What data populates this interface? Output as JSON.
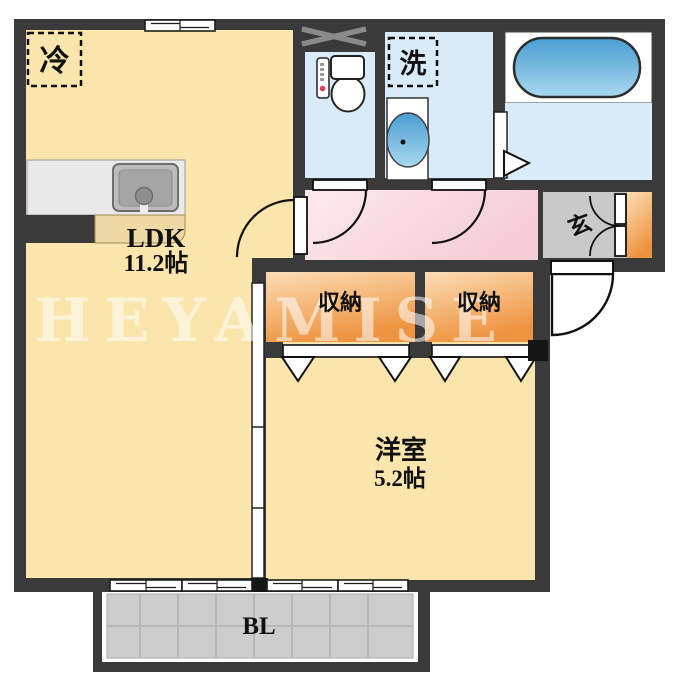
{
  "labels": {
    "ldk": "LDK",
    "ldk_size": "11.2帖",
    "western": "洋室",
    "western_size": "5.2帖",
    "storage1": "収納",
    "storage2": "収納",
    "entrance": "玄",
    "balcony": "BL",
    "fridge": "冷",
    "laundry": "洗",
    "watermark": "HEYAMISE"
  },
  "colors": {
    "wall": "#3A3A3A",
    "black": "#161616",
    "floor": "#FAE5AC",
    "water": "#D9EBF9",
    "white": "#FFFFFF",
    "hallway_light": "#FCEAEC",
    "hallway_dark": "#F5CDD6",
    "storage_light": "#FCDDB6",
    "storage_dark": "#EE9440",
    "entrance_gray": "#C9C9C9",
    "balcony_floor": "#CDCDCD",
    "tub_dark": "#4A9ED2",
    "tub_light": "#A8D8F0",
    "counter_gray": "#E9E9E9",
    "counter_tan": "#EED9A4"
  }
}
